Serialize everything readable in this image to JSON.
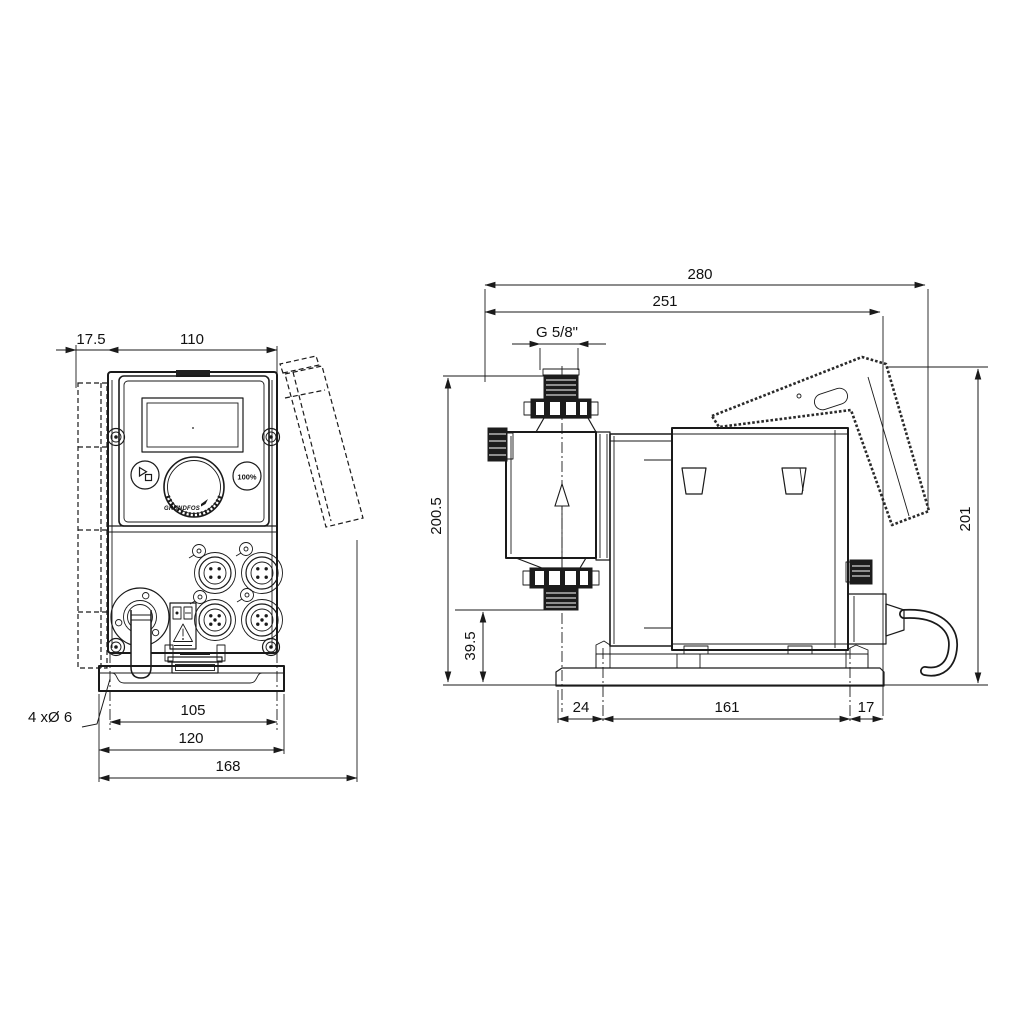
{
  "meta": {
    "background": "#ffffff",
    "line_color": "#1a1a1a",
    "drawing_type": "dimensional drawing, dosing pump front and side views"
  },
  "front_view": {
    "dims": {
      "wall_plate_depth": "17.5",
      "width": "110",
      "hole_pitch": "105",
      "base_width": "120",
      "overall_width": "168"
    },
    "mounting_holes_label": "4 xØ 6",
    "panel": {
      "max_capacity_button": "100%",
      "brand": "GRUNDFOS"
    }
  },
  "side_view": {
    "dims": {
      "overall_depth": "280",
      "depth_to_bracket": "251",
      "connection_thread": "G 5/8\"",
      "overall_height": "201",
      "height_to_connection": "200.5",
      "connection_height": "39.5",
      "base_front_offset": "24",
      "base_slot_pitch": "161",
      "base_rear_offset": "17"
    }
  }
}
